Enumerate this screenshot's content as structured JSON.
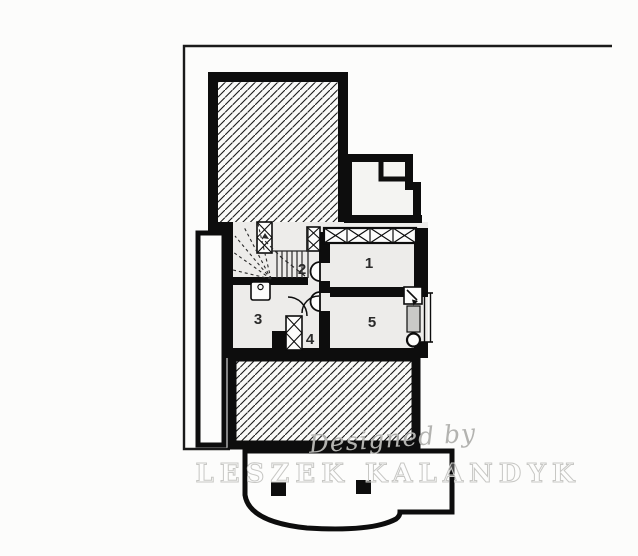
{
  "plan": {
    "type": "architectural-floor-plan",
    "level": "basement",
    "rooms": [
      {
        "id": "room-1",
        "label": "1"
      },
      {
        "id": "room-2",
        "label": "2"
      },
      {
        "id": "room-3",
        "label": "3"
      },
      {
        "id": "room-4",
        "label": "4"
      },
      {
        "id": "room-5",
        "label": "5"
      }
    ],
    "symbols": {
      "stairs": "winder-staircase-with-straight-flight",
      "door": "quarter-circle-door-swing",
      "chimney_column": "cross-hatched-column",
      "window_band": "cross-hatched-window-band",
      "sink": "wash-basin",
      "vent": "flue-arrow-square",
      "duct": "gray-duct",
      "cleanout": "circle",
      "pillar": "black-square-pillar",
      "hatched_area": "diagonal-hatch-slab"
    },
    "colors": {
      "wall": "#0d0d0d",
      "floor": "#edecea",
      "exterior": "#fcfcfb",
      "hatch_line": "#1a1a1a",
      "duct_fill": "#c9c9c7",
      "boundary_line": "#1a1a1a",
      "watermark": "#c7c7c4"
    }
  },
  "watermark": {
    "line1": "Designed by",
    "line2": "LESZEK KALANDYK"
  }
}
